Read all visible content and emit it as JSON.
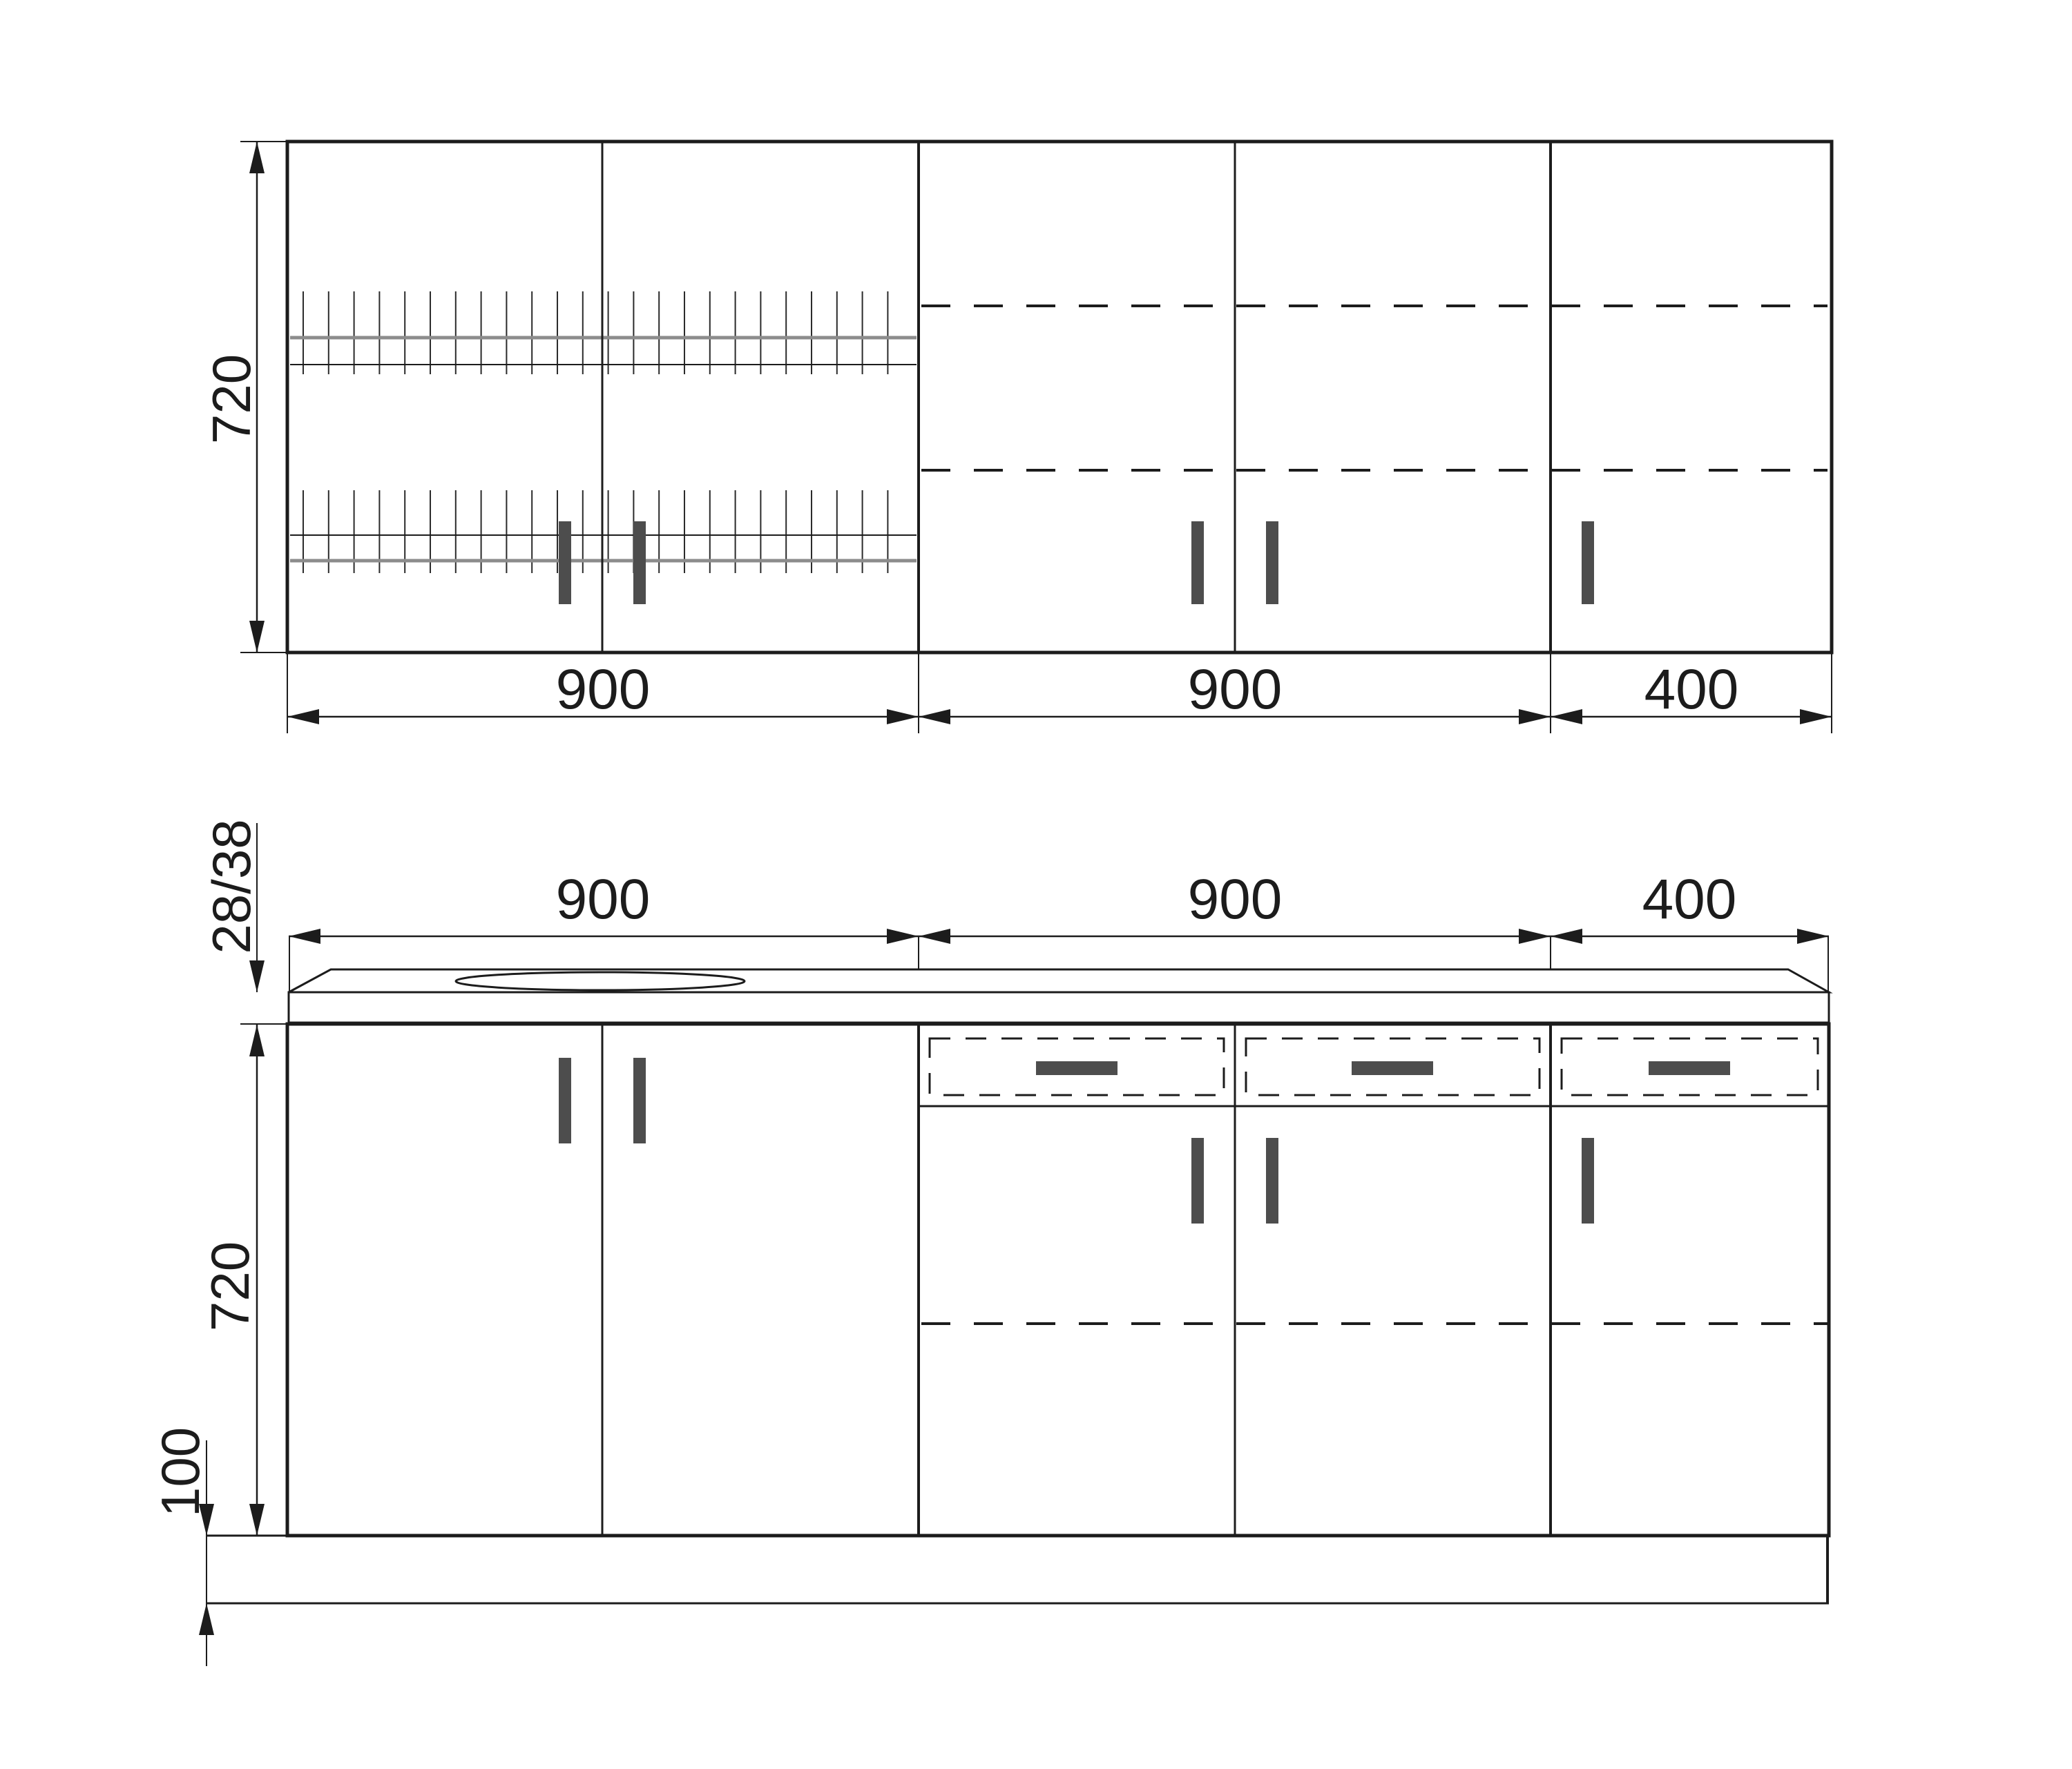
{
  "title": "Kitchen cabinet set — dimensioned elevation drawing",
  "colors": {
    "line": "#1c1c1c",
    "handle": "#4d4d4d",
    "rack_rail": "#8c8c8c",
    "background": "#ffffff"
  },
  "wall_row": {
    "height_label": "720",
    "width_labels": [
      "900",
      "900",
      "400"
    ]
  },
  "base_row": {
    "countertop_thickness_label": "28/38",
    "width_labels": [
      "900",
      "900",
      "400"
    ],
    "height_label": "720",
    "plinth_label": "100"
  }
}
